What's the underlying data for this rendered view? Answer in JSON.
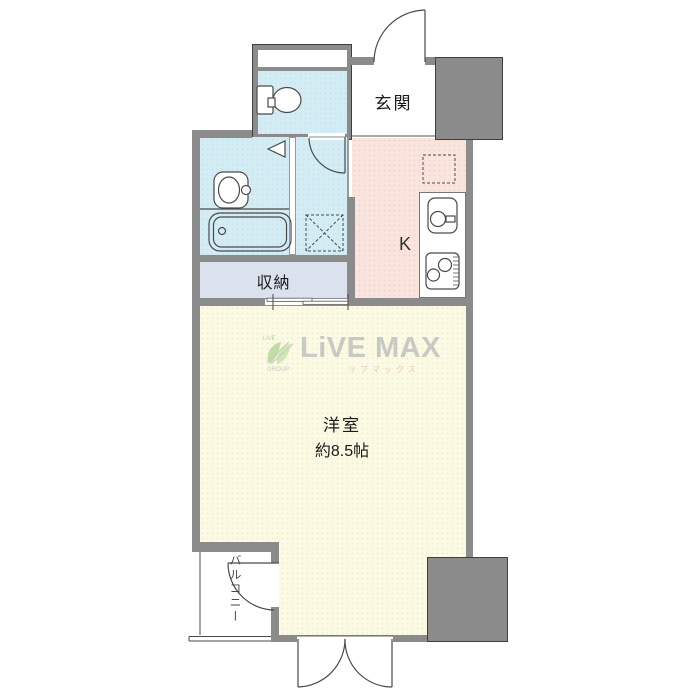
{
  "plan": {
    "labels": {
      "genkan": "玄関",
      "kitchen": "K",
      "storage": "収納",
      "main_room_type": "洋室",
      "main_room_size": "約8.5帖",
      "balcony": "バルコニー"
    },
    "watermark": {
      "brand": "LiVE MAX",
      "brand_kana": "リブマックス",
      "icon_text_top": "LiVE",
      "icon_text_bottom": "GROUP"
    },
    "colors": {
      "wall_gray": "#8b8b8b",
      "wet_area_blue": "#d4edf4",
      "kitchen_pink": "#f9e4de",
      "storage_blue_gray": "#dbe2ee",
      "main_room_cream": "#fbfae2",
      "watermark_gray": "#99a0ab",
      "watermark_green": "#8cc86e",
      "watermark_pink": "#dc96a8"
    },
    "icons": {
      "toilet": "toilet-icon",
      "washbasin": "washbasin-icon",
      "bathtub": "bathtub-icon",
      "washing_machine": "washing-machine-pan-icon",
      "refrigerator": "refrigerator-space-icon",
      "kitchen_sink": "kitchen-sink-icon",
      "stove": "stove-icon"
    }
  }
}
